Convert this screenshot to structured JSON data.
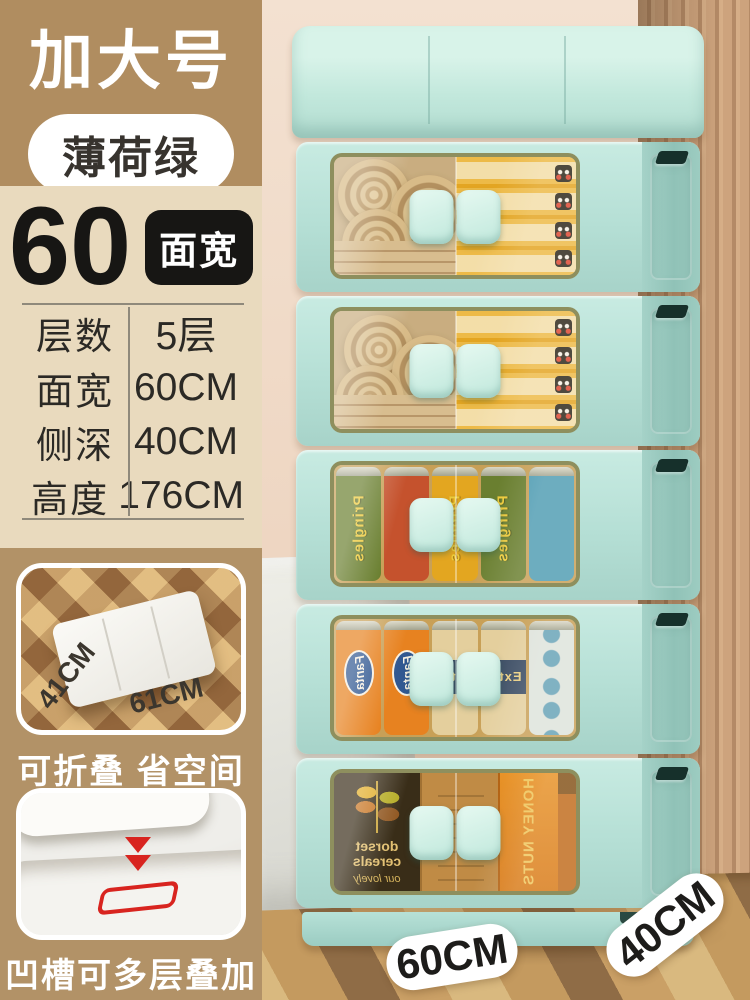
{
  "header": {
    "size_badge": "加大号",
    "color_badge": "薄荷绿"
  },
  "spec": {
    "number": "60",
    "number_unit_badge": "面宽",
    "rows": [
      {
        "label": "层数",
        "value": "5层"
      },
      {
        "label": "面宽",
        "value": "60CM"
      },
      {
        "label": "侧深",
        "value": "40CM"
      },
      {
        "label": "高度",
        "value": "176CM"
      }
    ]
  },
  "features": [
    {
      "caption": "可折叠 省空间",
      "dim_depth": "41CM",
      "dim_width": "61CM"
    },
    {
      "caption": "凹槽可多层叠加"
    }
  ],
  "floor_labels": {
    "width": "60CM",
    "depth": "40CM"
  },
  "photo_text": {
    "pringles": "Pringles",
    "fanta": "Fanta",
    "beer": "Extra",
    "cereal_brand": "dorset cereals",
    "cereal_sub": "our lovely",
    "honey_bag": "HONEY NUTS"
  },
  "shelves": [
    {
      "contents": "rolled towels and yellow snack boxes"
    },
    {
      "contents": "rolled towels and yellow snack boxes"
    },
    {
      "contents": "Pringles chip cans"
    },
    {
      "contents": "Fanta cans and beer cans"
    },
    {
      "contents": "cereal boxes and honey jar"
    }
  ],
  "colors": {
    "mint": "#b5dfd5",
    "tan_dark": "#b08d60",
    "tan_light": "#e9dabe",
    "badge_black": "#171614",
    "accent_red": "#d8241f"
  }
}
